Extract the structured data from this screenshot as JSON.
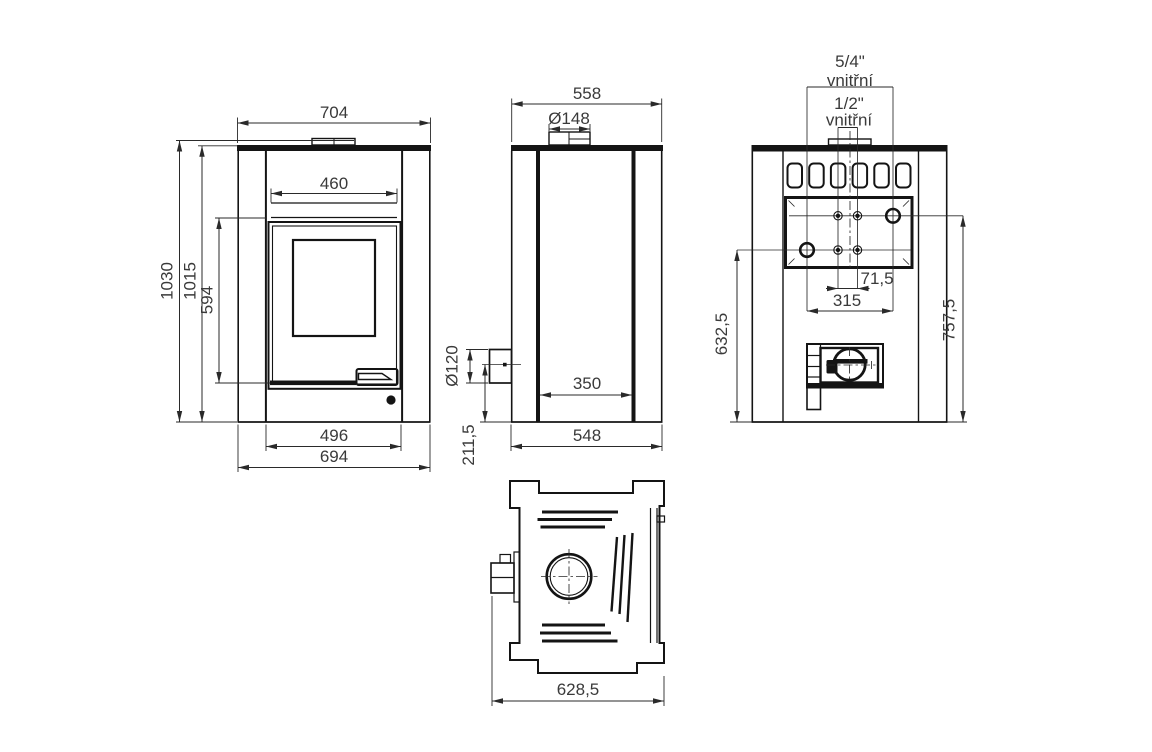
{
  "drawing": {
    "front": {
      "top_width": "704",
      "firebox_width": "460",
      "height_total": "1030",
      "height_body": "1015",
      "door_height": "594",
      "base_inner_width": "496",
      "base_width": "694"
    },
    "side": {
      "depth": "558",
      "flue_collar_dia": "Ø148",
      "rear_flue_dia": "Ø120",
      "inner_depth": "350",
      "rear_flue_height": "211,5",
      "base_depth": "548"
    },
    "rear": {
      "conn_large_size": "5/4\"",
      "conn_large_note": "vnitřní",
      "conn_small_size": "1/2\"",
      "conn_small_note": "vnitřní",
      "pair_spacing": "71,5",
      "conn_spacing": "315",
      "left_conn_height": "632,5",
      "right_conn_height": "757,5"
    },
    "top": {
      "total_depth": "628,5"
    },
    "colors": {
      "line": "#141414",
      "dim": "#2a2a2a",
      "text": "#3a3a3a"
    }
  }
}
